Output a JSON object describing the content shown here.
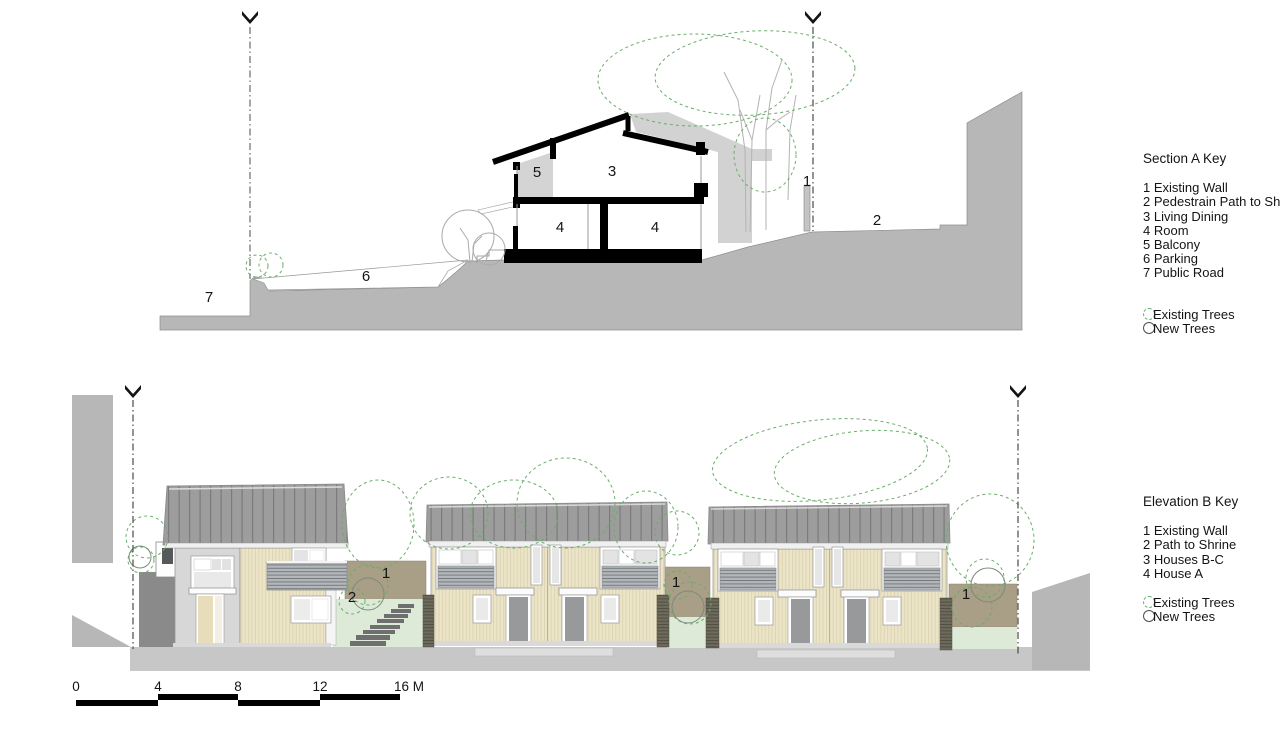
{
  "section_key": {
    "title": "Section  A Key",
    "items": [
      "1 Existing Wall",
      "2 Pedestrain Path to Shrine",
      "3 Living Dining",
      "4 Room",
      "5 Balcony",
      "6 Parking",
      "7 Public Road"
    ],
    "legend_existing": "Existing Trees",
    "legend_new": "New Trees"
  },
  "elevation_key": {
    "title": "Elevation  B Key",
    "items": [
      "1 Existing Wall",
      "2 Path to Shrine",
      "3 Houses B-C",
      "4 House A"
    ],
    "legend_existing": "Existing Trees",
    "legend_new": "New Trees"
  },
  "section_labels": {
    "existing_wall": "1",
    "pedestrian_path": "2",
    "living_dining": "3",
    "room_left": "4",
    "room_right": "4",
    "balcony": "5",
    "parking": "6",
    "public_road": "7"
  },
  "elevation_labels": {
    "existing_wall_left": "1",
    "path_to_shrine": "2",
    "existing_wall_mid": "1",
    "existing_wall_right": "1"
  },
  "scale_bar": {
    "ticks": [
      "0",
      "4",
      "8",
      "12",
      "16 M"
    ]
  },
  "colors": {
    "terrain": "#b7b7b7",
    "ground_strip": "#c7c7c7",
    "roof": "#9d9d9d",
    "siding": "#ebe4c6",
    "existing_wall_brown": "#a99e86",
    "new_planting_green": "#dcead7",
    "tree_dashed_green": "#6aad6a",
    "section_cut": "#000000",
    "dark_wall": "#8a8a8a"
  }
}
